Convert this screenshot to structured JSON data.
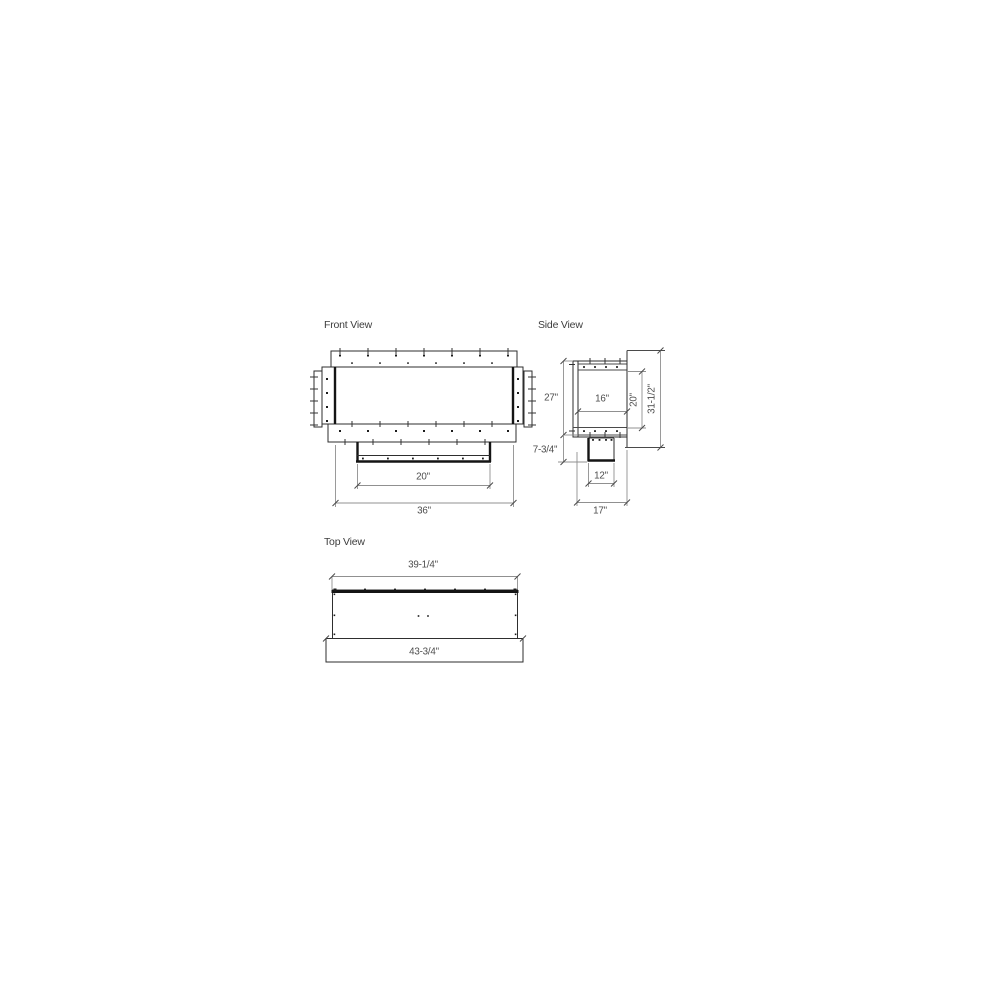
{
  "drawing": {
    "front": {
      "title": "Front View",
      "opening_width": "20\"",
      "overall_width": "36\""
    },
    "side": {
      "title": "Side View",
      "firebox_height": "27\"",
      "base_height": "7-3/4\"",
      "interior_depth": "16\"",
      "opening_height": "20\"",
      "overall_height": "31-1/2\"",
      "duct_depth": "12\"",
      "overall_depth": "17\""
    },
    "top": {
      "title": "Top View",
      "body_width": "39-1/4\"",
      "overall_width": "43-3/4\""
    }
  }
}
